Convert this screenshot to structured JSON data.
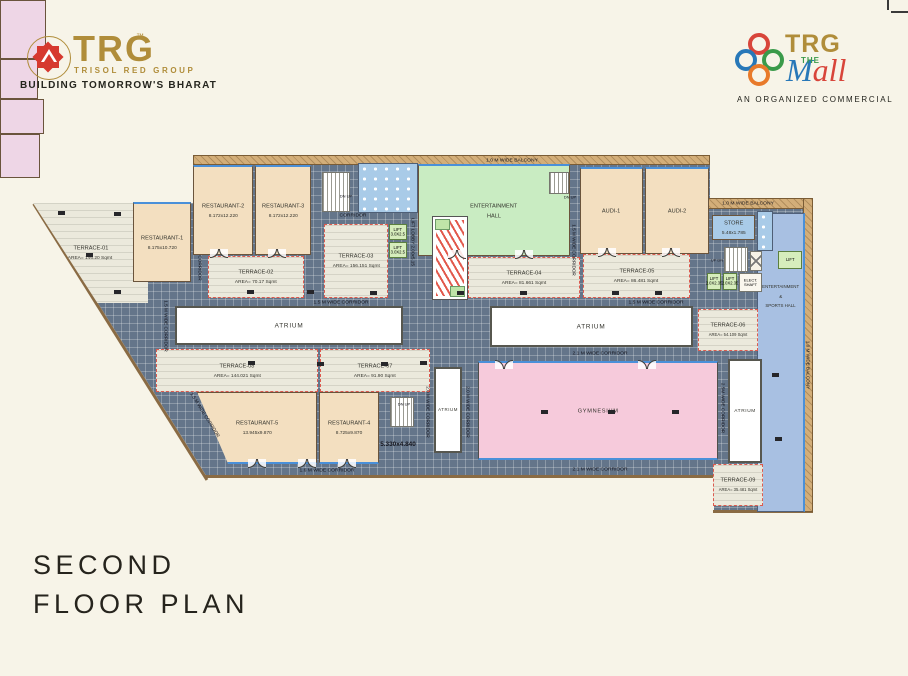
{
  "branding": {
    "left": {
      "brand": "TRG",
      "trademark": "™",
      "subtitle": "TRISOL RED GROUP",
      "tagline": "BUILDING TOMORROW'S BHARAT"
    },
    "right": {
      "brand": "TRG",
      "the": "THE",
      "mall_m": "M",
      "mall_all": "all",
      "tagline": "AN ORGANIZED COMMERCIAL"
    }
  },
  "title": {
    "line1": "SECOND",
    "line2": "FLOOR PLAN"
  },
  "rooms": {
    "restaurant1": {
      "name": "RESTAURANT-1",
      "dim": "8.175x10.720"
    },
    "restaurant2": {
      "name": "RESTAURANT-2",
      "dim": "8.172x12.220"
    },
    "restaurant3": {
      "name": "RESTAURANT-3",
      "dim": "8.172x12.220"
    },
    "restaurant4": {
      "name": "RESTAURANT-4",
      "dim": "8.725x9.870"
    },
    "restaurant5": {
      "name": "RESTAURANT-5",
      "dim": "13.945x9.870"
    },
    "terrace1": {
      "name": "TERRACE-01",
      "dim": "AREA= 146.20 Sqmt"
    },
    "terrace2": {
      "name": "TERRACE-02",
      "dim": "AREA= 70.17 Sqmt"
    },
    "terrace3": {
      "name": "TERRACE-03",
      "dim": "AREA= 156.151 Sqmt"
    },
    "terrace4": {
      "name": "TERRACE-04",
      "dim": "AREA= 81.661 Sqmt"
    },
    "terrace5": {
      "name": "TERRACE-05",
      "dim": "AREA= 86.481 Sqmt"
    },
    "terrace6": {
      "name": "TERRACE-06",
      "dim": "AREA= 54.109 Sqmt"
    },
    "terrace7": {
      "name": "TERRACE-07",
      "dim": "AREA= 91.90 Sqmt"
    },
    "terrace8": {
      "name": "TERRACE-08",
      "dim": "AREA= 144.021 Sqmt"
    },
    "terrace9": {
      "name": "TERRACE-09",
      "dim": "AREA= 35.481 Sqmt"
    },
    "audi1": {
      "name": "AUDI-1"
    },
    "audi2": {
      "name": "AUDI-2"
    },
    "store": {
      "name": "STORE",
      "dim": "5.48x1.785"
    },
    "entertainment_hall": {
      "line1": "ENTERTAINMENT",
      "line2": "HALL"
    },
    "gymnasium": {
      "name": "GYMNESIUM"
    },
    "sports_hall": {
      "line1": "ENTERTAINMENT",
      "line2": "&",
      "line3": "SPORTS HALL"
    },
    "atrium": "ATRIUM",
    "corridor": "CORRIDOR"
  },
  "labels": {
    "balcony": "1.0 M WIDE BALCONY",
    "corridor_15": "1.5 M WIDE CORRIDOR",
    "corridor_16": "1.6 M WIDE CORRIDOR",
    "corridor_20": "2.0 M WIDE CORRIDOR",
    "corridor_21": "2.1 M WIDE CORRIDOR",
    "corridor_25": "2.5M WIDE CORRIDOR",
    "lift_3025": "LIFT 3.0X2.5",
    "lift_2235": "LIFT 2.0X2.35",
    "lift_lobby": "LIFT LOBBY 2.00x5.15",
    "lift": "LIFT",
    "elect_shaft": "ELECT. SHAFT",
    "dn_up": "DN UP",
    "up_dn": "UP DN",
    "dim_note": "5.330x4.840"
  }
}
